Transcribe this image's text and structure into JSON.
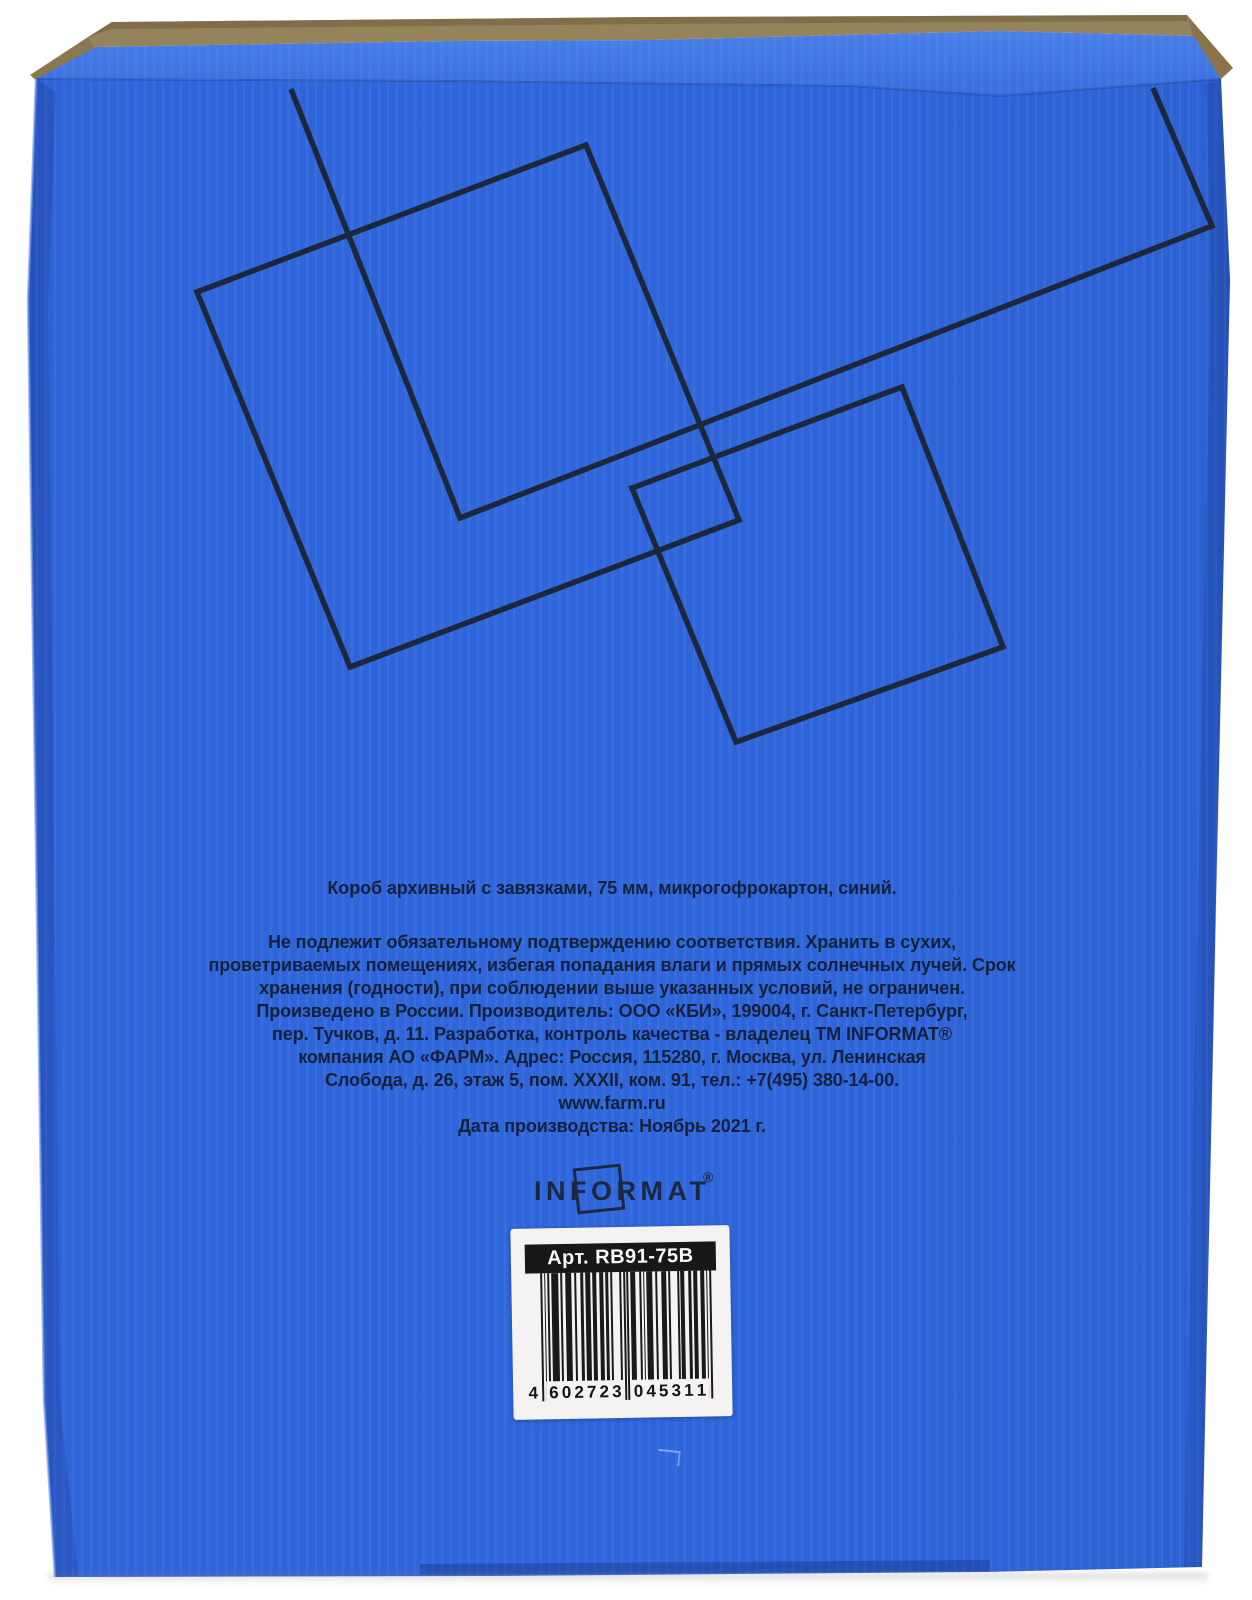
{
  "box": {
    "title_line": "Короб архивный с завязками, 75 мм, микрогофрокартон, синий.",
    "info_lines": [
      "Не подлежит обязательному подтверждению соответствия. Хранить в сухих,",
      "проветриваемых помещениях, избегая попадания влаги и прямых солнечных лучей. Срок",
      "хранения (годности), при соблюдении выше указанных условий, не ограничен.",
      "Произведено в России. Производитель: ООО «КБИ», 199004, г. Санкт-Петербург,",
      "пер. Тучков, д. 11. Разработка, контроль качества - владелец ТМ INFORMAT®",
      "компания АО «ФАРМ». Адрес: Россия, 115280, г. Москва, ул. Ленинская",
      "Слобода, д. 26, этаж 5, пом. XXXII, ком. 91, тел.: +7(495) 380-14-00.",
      "www.farm.ru",
      "Дата производства: Ноябрь 2021 г."
    ],
    "brand": "INFORMAT",
    "brand_reg": "®",
    "label": {
      "article": "Арт. RB91-75B",
      "barcode": "4602723045311"
    },
    "colors": {
      "face_blue": "#2f66dc",
      "bevel_blue": "#4077e5",
      "ink_navy": "#1c2434",
      "cardboard_tan": "#95835c",
      "label_white": "#f4f3f1"
    }
  }
}
